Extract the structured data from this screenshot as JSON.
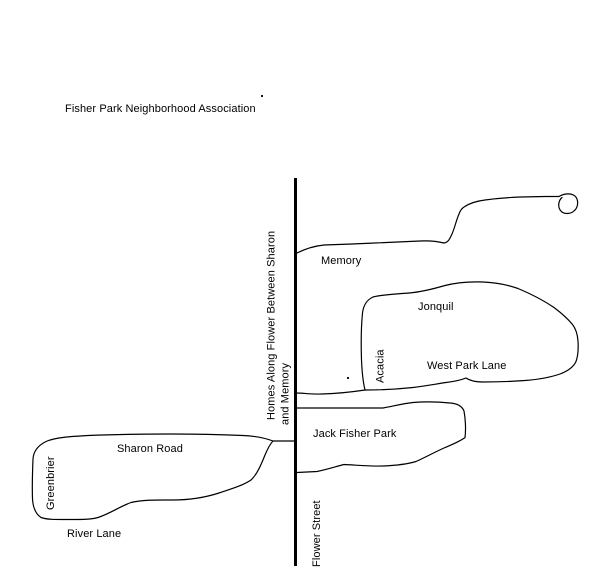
{
  "page": {
    "ink_color": "#000000",
    "background_color": "#ffffff"
  },
  "title": "Fisher Park Neighborhood Association",
  "labels": {
    "memory": "Memory",
    "jonquil": "Jonquil",
    "acacia": "Acacia",
    "west_park_lane": "West Park Lane",
    "jack_fisher_park": "Jack Fisher Park",
    "sharon_road": "Sharon Road",
    "greenbrier": "Greenbrier",
    "river_lane": "River Lane",
    "flower_street": "Flower Street",
    "homes_note_line1": "Homes Along Flower Between Sharon",
    "homes_note_line2": "and Memory"
  }
}
